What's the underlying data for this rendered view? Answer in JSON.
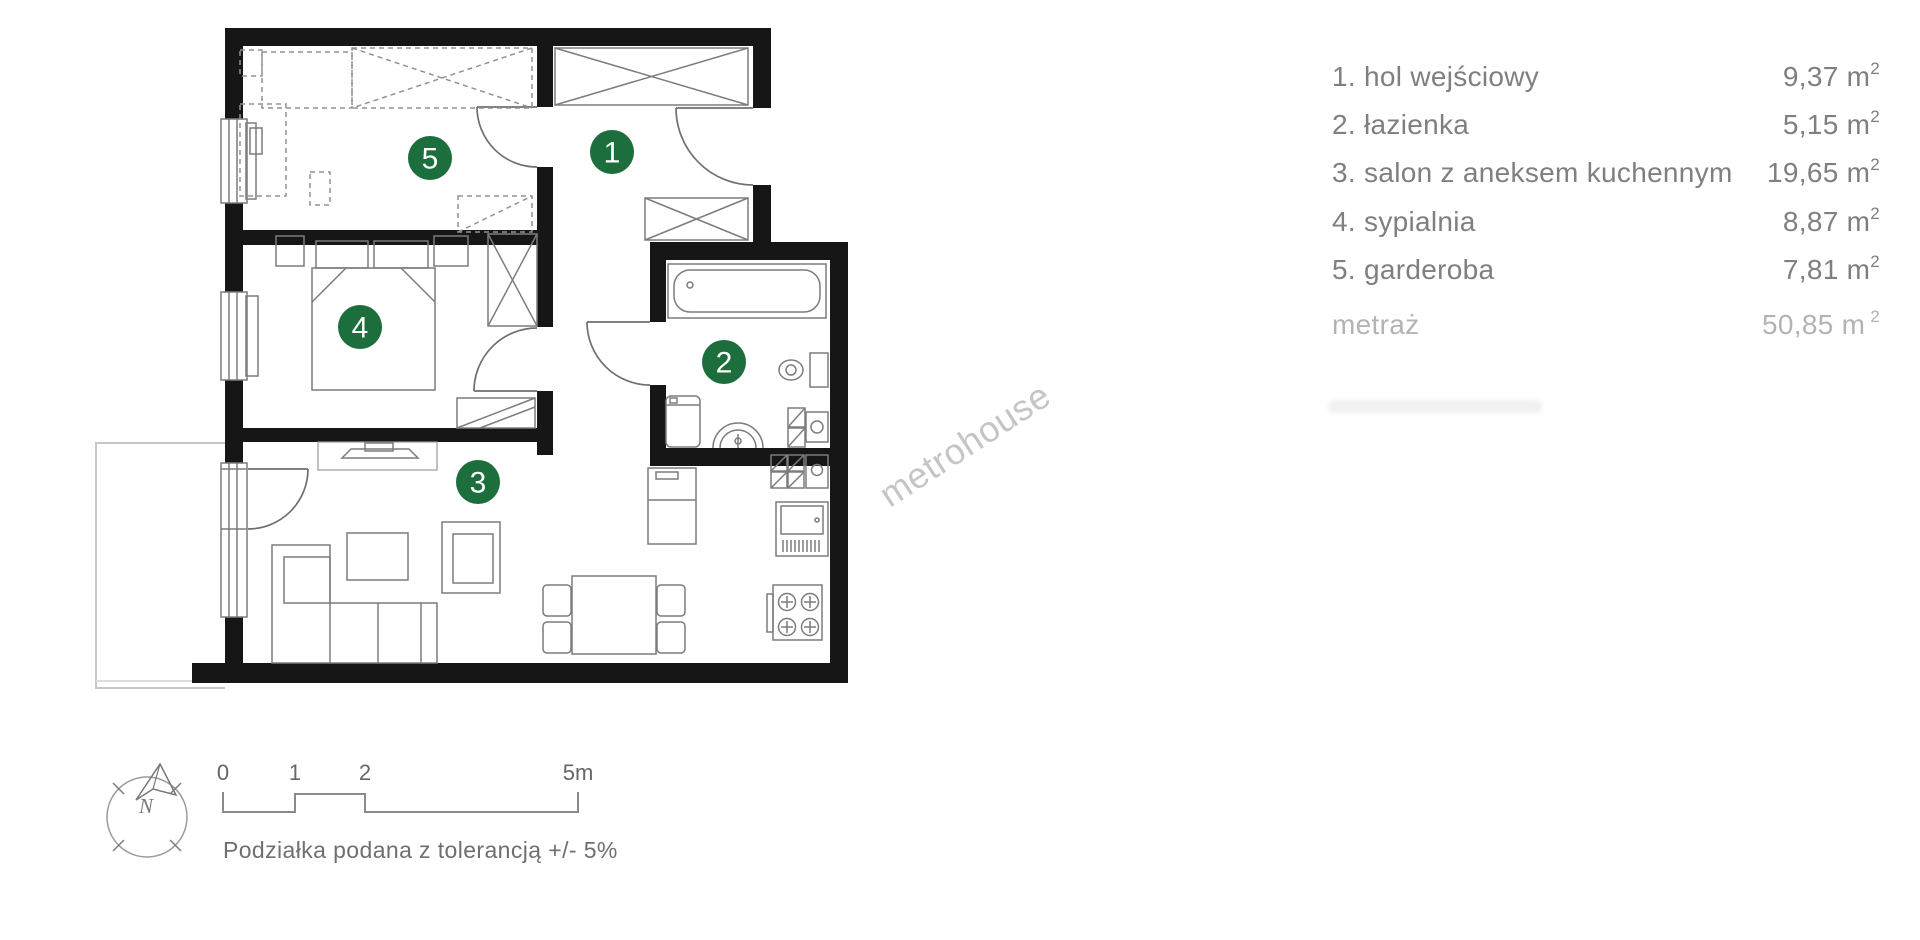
{
  "legend": {
    "rows": [
      {
        "label": "1. hol wejściowy",
        "value": "9,37",
        "unit": "m",
        "sup": "2"
      },
      {
        "label": "2. łazienka",
        "value": "5,15",
        "unit": "m",
        "sup": "2"
      },
      {
        "label": "3. salon z aneksem kuchennym",
        "value": "19,65",
        "unit": "m",
        "sup": "2"
      },
      {
        "label": "4. sypialnia",
        "value": "8,87",
        "unit": "m",
        "sup": "2"
      },
      {
        "label": "5. garderoba",
        "value": "7,81",
        "unit": "m",
        "sup": "2"
      }
    ],
    "total_row": {
      "label": "metraż",
      "value": "50,85",
      "unit": "m",
      "sup": "2"
    }
  },
  "floor_plan": {
    "badges": [
      {
        "number": "1"
      },
      {
        "number": "2"
      },
      {
        "number": "3"
      },
      {
        "number": "4"
      },
      {
        "number": "5"
      }
    ]
  },
  "compass": {
    "label": "N"
  },
  "scale_bar": {
    "tick_labels": [
      "0",
      "1",
      "2",
      "5m"
    ],
    "note": "Podziałka podana z tolerancją +/- 5%"
  },
  "watermark": {
    "text": "metrohouse"
  },
  "colors": {
    "badge_green": "#1c6e3c",
    "wall_black": "#161616",
    "legend_text": "#7f7f7f",
    "legend_muted": "#b3b3b3",
    "watermark_gray": "#c5c5c5"
  }
}
